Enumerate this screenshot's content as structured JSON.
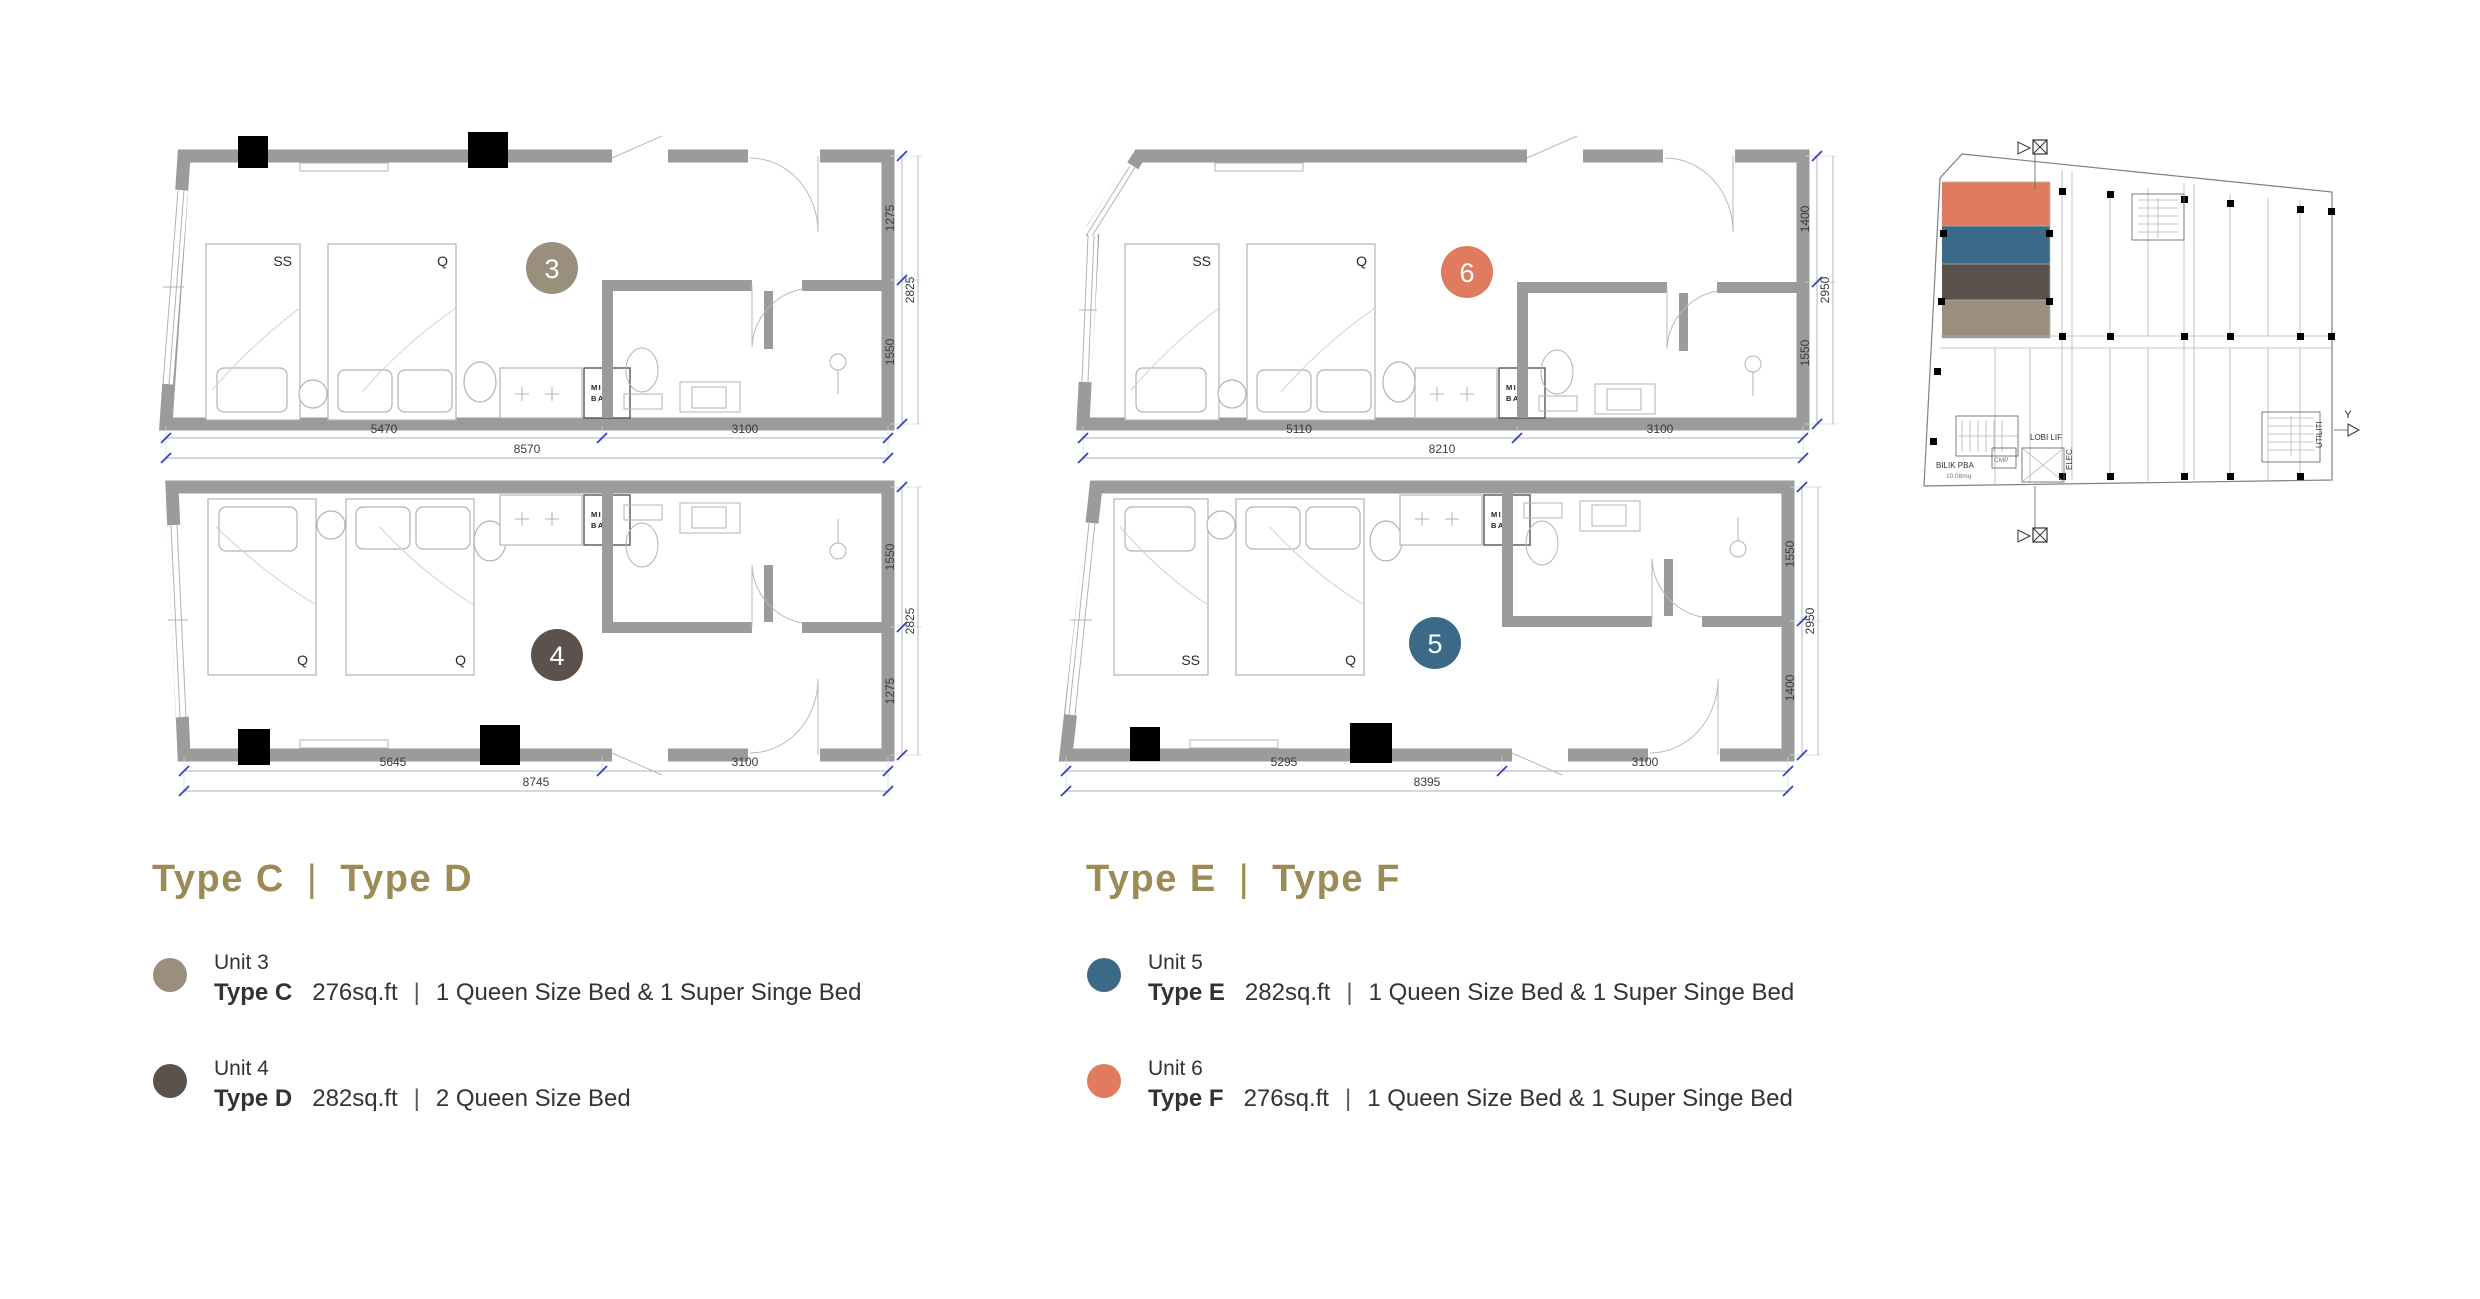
{
  "colors": {
    "taupe": "#9A8E7C",
    "brown": "#5B524E",
    "blue": "#3A6A87",
    "salmon": "#E07B5F",
    "gold": "#9C8B55",
    "wall": "#9b9b9b"
  },
  "units": {
    "u3": {
      "number": "3",
      "bed1": "SS",
      "bed2": "Q",
      "minibar1": "MINI",
      "minibar2": "BAR",
      "dim_a": "5470",
      "dim_b": "3100",
      "dim_total": "8570",
      "dim_r1": "1275",
      "dim_r2": "1550",
      "dim_r_total": "2825"
    },
    "u6": {
      "number": "6",
      "bed1": "SS",
      "bed2": "Q",
      "minibar1": "MINI",
      "minibar2": "BAR",
      "dim_a": "5110",
      "dim_b": "3100",
      "dim_total": "8210",
      "dim_r1": "1400",
      "dim_r2": "1550",
      "dim_r_total": "2950"
    },
    "u4": {
      "number": "4",
      "bed1": "Q",
      "bed2": "Q",
      "minibar1": "MINI",
      "minibar2": "BAR",
      "dim_a": "5645",
      "dim_b": "3100",
      "dim_total": "8745",
      "dim_r1": "1550",
      "dim_r2": "1275",
      "dim_r_total": "2825"
    },
    "u5": {
      "number": "5",
      "bed1": "SS",
      "bed2": "Q",
      "minibar1": "MINI",
      "minibar2": "BAR",
      "dim_a": "5295",
      "dim_b": "3100",
      "dim_total": "8395",
      "dim_r1": "1550",
      "dim_r2": "1400",
      "dim_r_total": "2950"
    }
  },
  "key_plan": {
    "lobby": "LOBI LIF",
    "bilik": "BILIK PBA",
    "bilik_area": "10.08mq",
    "elec": "ELEC.",
    "cmp": "CMP",
    "utility": "UTILITI",
    "axis_y": "Y"
  },
  "legend_left": {
    "title_a": "Type C",
    "sep": "|",
    "title_b": "Type D",
    "items": [
      {
        "unit": "Unit 3",
        "type": "Type C",
        "size": "276sq.ft",
        "sep": "|",
        "desc": "1 Queen Size Bed & 1 Super Singe Bed"
      },
      {
        "unit": "Unit 4",
        "type": "Type D",
        "size": "282sq.ft",
        "sep": "|",
        "desc": "2 Queen Size Bed"
      }
    ]
  },
  "legend_right": {
    "title_a": "Type E",
    "sep": "|",
    "title_b": "Type F",
    "items": [
      {
        "unit": "Unit 5",
        "type": "Type E",
        "size": "282sq.ft",
        "sep": "|",
        "desc": "1 Queen Size Bed & 1 Super Singe Bed"
      },
      {
        "unit": "Unit 6",
        "type": "Type F",
        "size": "276sq.ft",
        "sep": "|",
        "desc": "1 Queen Size Bed & 1 Super Singe Bed"
      }
    ]
  }
}
